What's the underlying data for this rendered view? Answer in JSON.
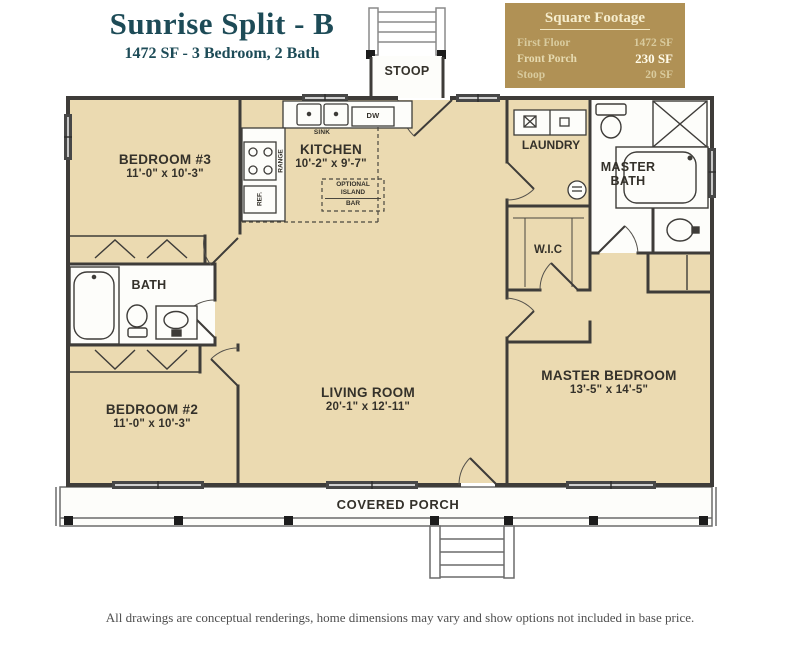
{
  "header": {
    "title": "Sunrise Split - B",
    "subtitle": "1472 SF - 3 Bedroom, 2 Bath"
  },
  "square_footage": {
    "title": "Square Footage",
    "rows": [
      {
        "label": "First Floor",
        "value": "1472 SF"
      },
      {
        "label": "Front Porch",
        "value": "230 SF"
      },
      {
        "label": "Stoop",
        "value": "20 SF"
      }
    ]
  },
  "rooms": {
    "bedroom3": {
      "name": "BEDROOM #3",
      "dims": "11'-0\" x 10'-3\""
    },
    "bedroom2": {
      "name": "BEDROOM #2",
      "dims": "11'-0\" x 10'-3\""
    },
    "kitchen": {
      "name": "KITCHEN",
      "dims": "10'-2\" x 9'-7\""
    },
    "living_room": {
      "name": "LIVING ROOM",
      "dims": "20'-1\" x 12'-11\""
    },
    "master_bedroom": {
      "name": "MASTER BEDROOM",
      "dims": "13'-5\" x 14'-5\""
    },
    "master_bath": {
      "name": "MASTER BATH"
    },
    "bath": {
      "name": "BATH"
    },
    "laundry": {
      "name": "LAUNDRY"
    },
    "wic": {
      "name": "W.I.C"
    },
    "stoop": {
      "name": "STOOP"
    },
    "covered_porch": {
      "name": "COVERED PORCH"
    }
  },
  "fixtures": {
    "sink": "SINK",
    "dw": "DW",
    "range": "RANGE",
    "ref": "REF.",
    "island_line1": "OPTIONAL",
    "island_line2": "ISLAND",
    "island_line3": "BAR"
  },
  "footer": {
    "disclaimer": "All drawings are conceptual renderings, home dimensions may vary and show options not included in base price."
  },
  "colors": {
    "accent_gold": "#b09155",
    "title_teal": "#1d4b57",
    "floor_cream": "#ebdab1",
    "wall_dark": "#3e3c39"
  }
}
